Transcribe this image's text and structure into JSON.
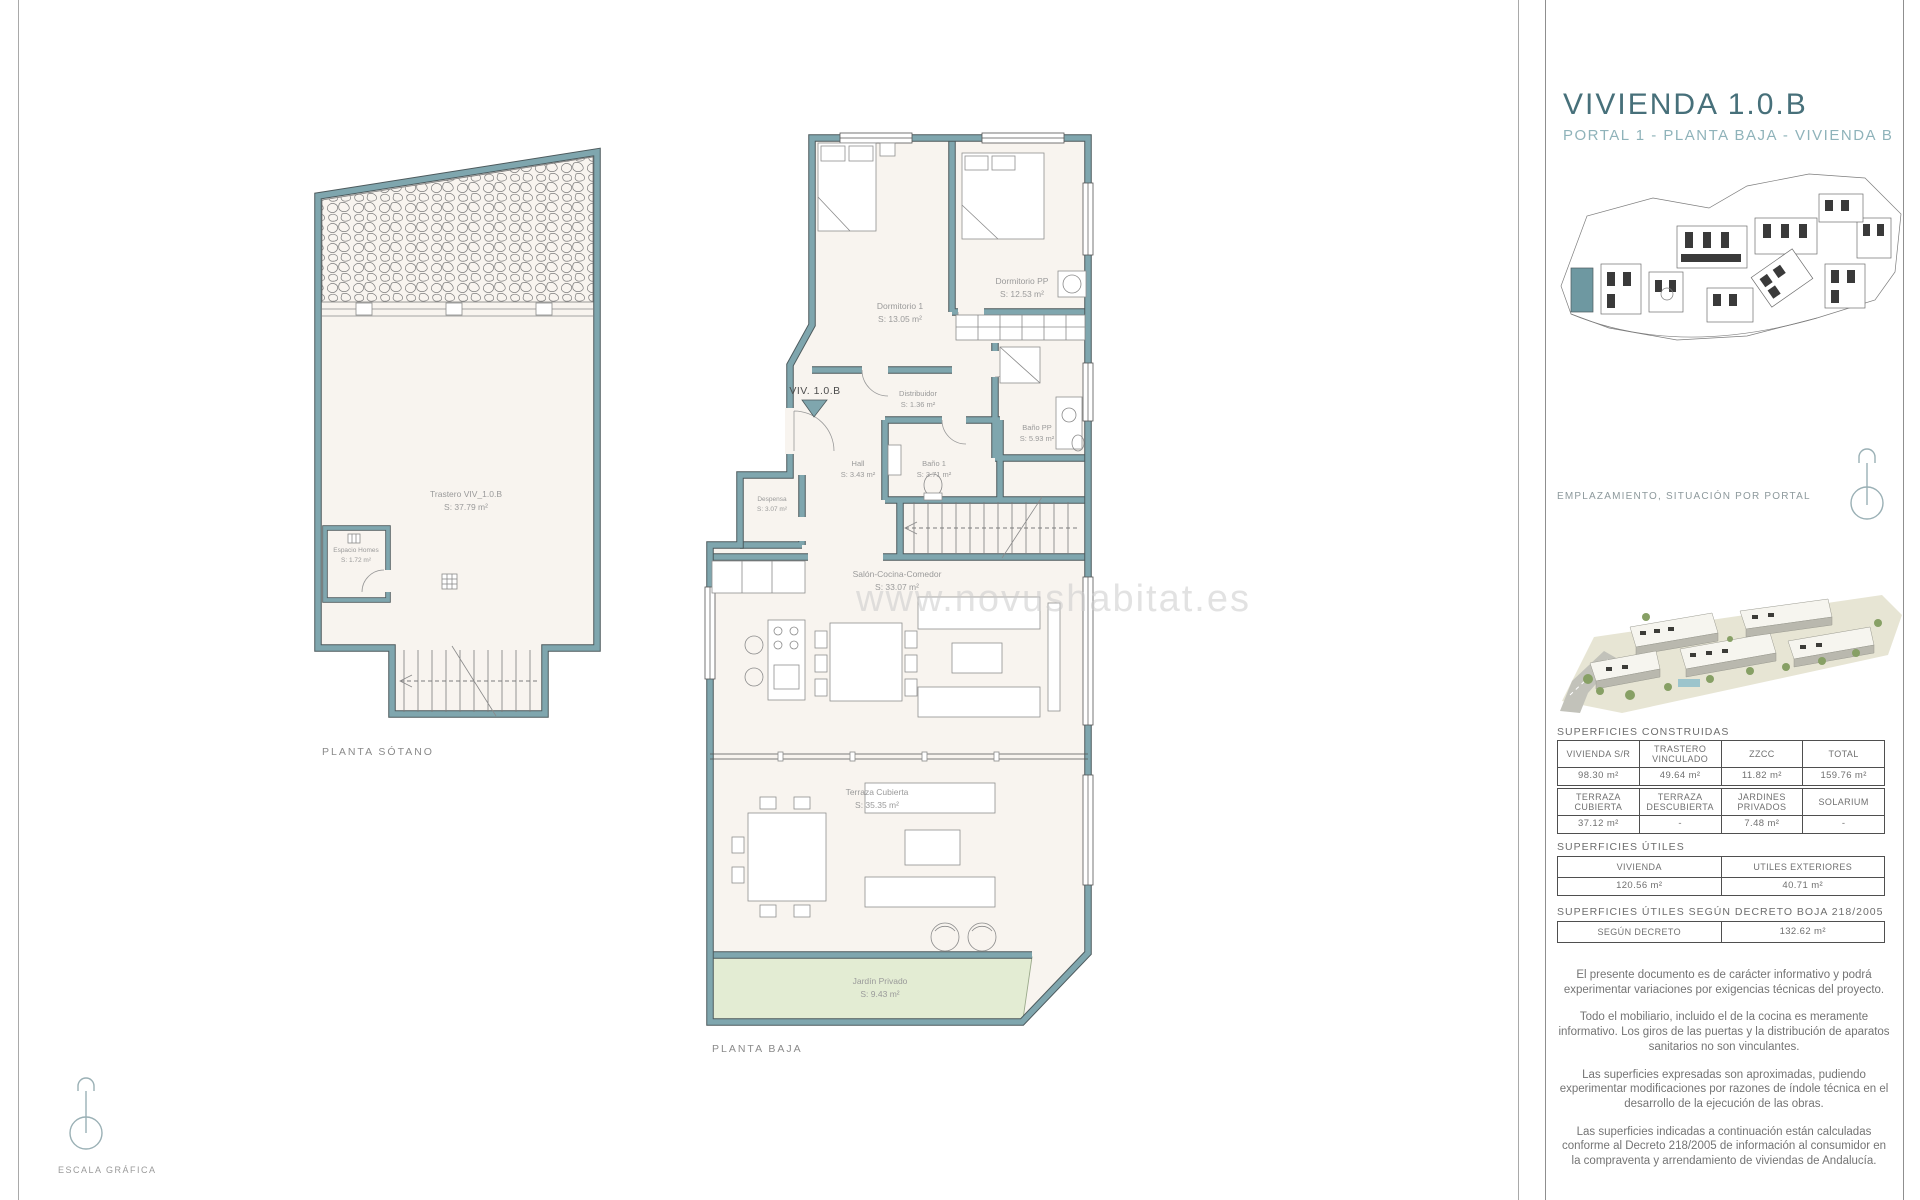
{
  "panel": {
    "title": "VIVIENDA 1.0.B",
    "subtitle": "PORTAL 1 - PLANTA BAJA - VIVIENDA B",
    "emplazamiento_label": "EMPLAZAMIENTO, SITUACIÓN POR PORTAL",
    "sections": {
      "construidas_title": "SUPERFICIES CONSTRUIDAS",
      "utiles_title": "SUPERFICIES ÚTILES",
      "decreto_title": "SUPERFICIES ÚTILES SEGÚN DECRETO BOJA 218/2005"
    },
    "tables": {
      "construidas": {
        "headers": [
          "VIVIENDA S/R",
          "TRASTERO VINCULADO",
          "ZZCC",
          "TOTAL"
        ],
        "values": [
          "98.30 m²",
          "49.64 m²",
          "11.82 m²",
          "159.76 m²"
        ]
      },
      "exteriores": {
        "headers": [
          "TERRAZA CUBIERTA",
          "TERRAZA DESCUBIERTA",
          "JARDINES PRIVADOS",
          "SOLARIUM"
        ],
        "values": [
          "37.12 m²",
          "-",
          "7.48 m²",
          "-"
        ]
      },
      "utiles": {
        "headers": [
          "VIVIENDA",
          "UTILES EXTERIORES"
        ],
        "values": [
          "120.56 m²",
          "40.71 m²"
        ]
      },
      "decreto": {
        "headers": [
          "SEGÚN DECRETO"
        ],
        "values": [
          "132.62 m²"
        ]
      }
    },
    "legal": [
      "El presente documento es de carácter informativo y podrá experimentar variaciones por exigencias técnicas del  proyecto.",
      "Todo el mobiliario, incluido el de la cocina es meramente informativo. Los giros de las puertas y la distribución de aparatos sanitarios no son vinculantes.",
      "Las superficies expresadas son aproximadas, pudiendo experimentar modificaciones por razones de índole técnica en el desarrollo de la ejecución de las obras.",
      "Las superficies indicadas a continuación están calculadas conforme al Decreto 218/2005 de  información al consumidor en la compraventa y arrendamiento de viviendas de Andalucía."
    ]
  },
  "plans": {
    "sotano": {
      "caption": "PLANTA SÓTANO",
      "rooms": {
        "trastero": {
          "name": "Trastero VIV_1.0.B",
          "area": "S: 37.79 m²"
        },
        "espacio_homes": {
          "name": "Espacio Homes",
          "area": "S: 1.72 m²"
        }
      }
    },
    "baja": {
      "caption": "PLANTA BAJA",
      "entry_label": "VIV. 1.0.B",
      "rooms": {
        "dormitorio1": {
          "name": "Dormitorio 1",
          "area": "S: 13.05 m²"
        },
        "dormitorio_pp": {
          "name": "Dormitorio PP",
          "area": "S: 12.53 m²"
        },
        "distribuidor": {
          "name": "Distribuidor",
          "area": "S: 1.36 m²"
        },
        "bano_pp": {
          "name": "Baño PP",
          "area": "S: 5.93 m²"
        },
        "hall": {
          "name": "Hall",
          "area": "S: 3.43 m²"
        },
        "bano1": {
          "name": "Baño 1",
          "area": "S: 3.71 m²"
        },
        "despensa": {
          "name": "Despensa",
          "area": "S: 3.07 m²"
        },
        "salon": {
          "name": "Salón-Cocina-Comedor",
          "area": "S: 33.07 m²"
        },
        "terraza": {
          "name": "Terraza Cubierta",
          "area": "S: 35.35 m²"
        },
        "jardin": {
          "name": "Jardín Privado",
          "area": "S: 9.43 m²"
        }
      }
    }
  },
  "watermark": {
    "text": "www.novushabitat.es"
  },
  "footer": {
    "escala_label": "ESCALA GRÁFICA"
  },
  "colors": {
    "wall": "#7fa6ae",
    "floor": "#f8f4ef",
    "garden": "#e3ecd3",
    "accent_dark": "#47707a",
    "accent_light": "#8fb3ba"
  }
}
